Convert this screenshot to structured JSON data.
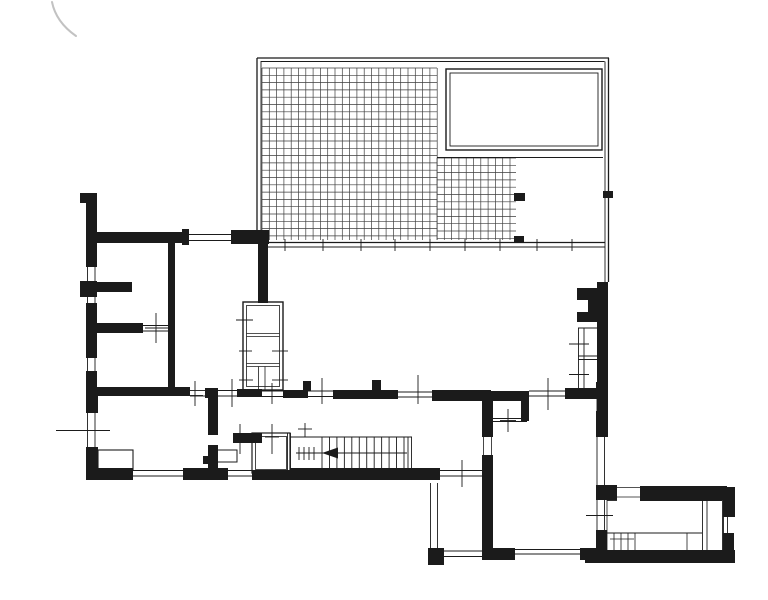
{
  "document": {
    "type": "scanned architectural floor plan drawing",
    "canvas": {
      "width": 768,
      "height": 600
    }
  },
  "colors": {
    "paper": "#ffffff",
    "ink": "#1b1b1b",
    "grid": "#3d3d3d",
    "pencil": "#c2c2c2"
  },
  "plan": {
    "pencil_mark_path": "M52,2 Q56,22 76,36",
    "grids": [
      {
        "x0": 262,
        "y0": 68,
        "x1": 437,
        "y1": 240,
        "step": 7.3
      },
      {
        "x0": 437,
        "y0": 158,
        "x1": 516,
        "y1": 240,
        "step": 7.3
      }
    ],
    "outline_rects": [
      [
        446,
        69,
        156,
        81,
        1.4
      ],
      [
        450,
        73,
        148,
        73,
        0.9
      ],
      [
        243,
        302,
        40,
        88,
        1.4
      ],
      [
        246.5,
        305.5,
        33,
        81,
        0.8
      ],
      [
        252,
        433,
        38,
        40,
        1.2
      ],
      [
        255.5,
        436.5,
        31,
        33,
        0.8
      ],
      [
        215,
        450,
        22,
        12,
        1
      ],
      [
        98,
        450,
        35,
        20,
        1.1
      ]
    ],
    "black_rects": [
      [
        80,
        193,
        17,
        10
      ],
      [
        86,
        203,
        11,
        30
      ],
      [
        86,
        232,
        102,
        11
      ],
      [
        182,
        229,
        7,
        16
      ],
      [
        231,
        230,
        38,
        14
      ],
      [
        86,
        243,
        11,
        24
      ],
      [
        86,
        281,
        11,
        16
      ],
      [
        80,
        281,
        6,
        16
      ],
      [
        86,
        303,
        11,
        55
      ],
      [
        86,
        371,
        11,
        27
      ],
      [
        97,
        282,
        35,
        10
      ],
      [
        95,
        323,
        48,
        10
      ],
      [
        168,
        243,
        7,
        147
      ],
      [
        97,
        387,
        93,
        9
      ],
      [
        205,
        388,
        13,
        10
      ],
      [
        208,
        398,
        10,
        37
      ],
      [
        208,
        445,
        10,
        23
      ],
      [
        237,
        389,
        25,
        8
      ],
      [
        283,
        390,
        25,
        8
      ],
      [
        303,
        381,
        8,
        10
      ],
      [
        333,
        390,
        65,
        9
      ],
      [
        372,
        380,
        9,
        14
      ],
      [
        432,
        390,
        59,
        11
      ],
      [
        482,
        391,
        47,
        10
      ],
      [
        521,
        392,
        8,
        29
      ],
      [
        482,
        392,
        11,
        45
      ],
      [
        482,
        455,
        11,
        102
      ],
      [
        565,
        388,
        42,
        11
      ],
      [
        596,
        382,
        11,
        15
      ],
      [
        596,
        411,
        11,
        26
      ],
      [
        596,
        485,
        11,
        15
      ],
      [
        596,
        530,
        11,
        21
      ],
      [
        258,
        243,
        10,
        60
      ],
      [
        233,
        433,
        29,
        10
      ],
      [
        86,
        388,
        12,
        25
      ],
      [
        86,
        447,
        12,
        33
      ],
      [
        86,
        468,
        47,
        12
      ],
      [
        183,
        468,
        45,
        12
      ],
      [
        252,
        470,
        38,
        10
      ],
      [
        290,
        468,
        150,
        12
      ],
      [
        203,
        456,
        9,
        8
      ],
      [
        428,
        548,
        16,
        17
      ],
      [
        482,
        548,
        33,
        12
      ],
      [
        580,
        548,
        27,
        12
      ],
      [
        585,
        550,
        150,
        13
      ],
      [
        600,
        485,
        17,
        15
      ],
      [
        640,
        486,
        87,
        14
      ],
      [
        723,
        487,
        12,
        30
      ],
      [
        723,
        533,
        11,
        30
      ],
      [
        597,
        282,
        11,
        155
      ],
      [
        514,
        193,
        11,
        8
      ],
      [
        514,
        236,
        10,
        7
      ],
      [
        603,
        191,
        10,
        7
      ]
    ],
    "polygons": [
      "577,288 597,288 597,322 577,322 577,312 588,312 588,300 577,300"
    ],
    "lines": [
      [
        257,
        232,
        257,
        58,
        1.3
      ],
      [
        261,
        232,
        261,
        61,
        0.9
      ],
      [
        257,
        58,
        609,
        58,
        1.3
      ],
      [
        261,
        61.5,
        604.5,
        61.5,
        0.9
      ],
      [
        608.5,
        58,
        608.5,
        282,
        1.3
      ],
      [
        605,
        61.5,
        605,
        282,
        0.9
      ],
      [
        437,
        157.5,
        603,
        157.5,
        0.9
      ],
      [
        268,
        242.5,
        605,
        242.5,
        1.2
      ],
      [
        268,
        247,
        605,
        247,
        0.9
      ],
      [
        285,
        239,
        285,
        251,
        0.9
      ],
      [
        323,
        239,
        323,
        251,
        0.9
      ],
      [
        361,
        239,
        361,
        251,
        0.9
      ],
      [
        395,
        239,
        395,
        251,
        0.9
      ],
      [
        430,
        239,
        430,
        251,
        0.9
      ],
      [
        465,
        239,
        465,
        251,
        0.9
      ],
      [
        500,
        239,
        500,
        251,
        0.9
      ],
      [
        537,
        239,
        537,
        251,
        0.9
      ],
      [
        572,
        239,
        572,
        251,
        0.9
      ],
      [
        189,
        234.5,
        231,
        234.5,
        0.9
      ],
      [
        189,
        240.5,
        231,
        240.5,
        0.9
      ],
      [
        87.5,
        267,
        87.5,
        281,
        0.9
      ],
      [
        95,
        267,
        95,
        281,
        0.9
      ],
      [
        87.5,
        297,
        87.5,
        303,
        0.9
      ],
      [
        95,
        297,
        95,
        303,
        0.9
      ],
      [
        87.5,
        358,
        87.5,
        371,
        0.9
      ],
      [
        95,
        358,
        95,
        371,
        0.9
      ],
      [
        87.5,
        413,
        87.5,
        447,
        0.9
      ],
      [
        95,
        413,
        95,
        447,
        0.9
      ],
      [
        56,
        430.5,
        110,
        430.5,
        0.9
      ],
      [
        143,
        325.5,
        168,
        325.5,
        0.9
      ],
      [
        143,
        331,
        168,
        331,
        0.9
      ],
      [
        156,
        313,
        156,
        343,
        0.9
      ],
      [
        145,
        328,
        168,
        328,
        0.9
      ],
      [
        133,
        470.5,
        183,
        470.5,
        0.9
      ],
      [
        133,
        476,
        183,
        476,
        0.9
      ],
      [
        228,
        470.5,
        252,
        470.5,
        0.9
      ],
      [
        228,
        476,
        252,
        476,
        0.9
      ],
      [
        190,
        390.5,
        205,
        390.5,
        0.9
      ],
      [
        190,
        396,
        205,
        396,
        0.9
      ],
      [
        195,
        381,
        195,
        406,
        0.9
      ],
      [
        188,
        395.5,
        203,
        395.5,
        0.9
      ],
      [
        218,
        390.5,
        237,
        390.5,
        0.9
      ],
      [
        218,
        396,
        237,
        396,
        0.9
      ],
      [
        232,
        379,
        232,
        407,
        0.9
      ],
      [
        262,
        391,
        283,
        391,
        0.9
      ],
      [
        262,
        396.5,
        283,
        396.5,
        0.9
      ],
      [
        272,
        383,
        272,
        404,
        0.9
      ],
      [
        308,
        391,
        333,
        391,
        0.9
      ],
      [
        308,
        396.5,
        333,
        396.5,
        0.9
      ],
      [
        322,
        378,
        322,
        404,
        0.9
      ],
      [
        398,
        392,
        432,
        392,
        0.9
      ],
      [
        398,
        397,
        432,
        397,
        0.9
      ],
      [
        418,
        375,
        418,
        404,
        0.9
      ],
      [
        529,
        391,
        565,
        391,
        0.9
      ],
      [
        529,
        396,
        565,
        396,
        0.9
      ],
      [
        548,
        378,
        548,
        410,
        0.9
      ],
      [
        246.5,
        333.5,
        279.5,
        333.5,
        0.8
      ],
      [
        246.5,
        336.5,
        279.5,
        336.5,
        0.8
      ],
      [
        246.5,
        363.5,
        279.5,
        363.5,
        0.8
      ],
      [
        246.5,
        366.5,
        279.5,
        366.5,
        0.8
      ],
      [
        258.5,
        366.5,
        258.5,
        389.5,
        0.8
      ],
      [
        265,
        366.5,
        265,
        389.5,
        0.8
      ],
      [
        236,
        320,
        253,
        320,
        0.9
      ],
      [
        239,
        351,
        252,
        351,
        0.9
      ],
      [
        272,
        351,
        288,
        351,
        0.9
      ],
      [
        239,
        380,
        253,
        380,
        0.9
      ],
      [
        272,
        380,
        288,
        380,
        0.9
      ],
      [
        287.5,
        433,
        287.5,
        470,
        0.9
      ],
      [
        290.5,
        433,
        290.5,
        470,
        0.9
      ],
      [
        290,
        437,
        412,
        437,
        0.9
      ],
      [
        408,
        437,
        408,
        468,
        0.9
      ],
      [
        411.5,
        437,
        411.5,
        468,
        0.9
      ],
      [
        305,
        423,
        305,
        437,
        0.9
      ],
      [
        298,
        429,
        312,
        429,
        0.9
      ],
      [
        240,
        424,
        240,
        454,
        0.9
      ],
      [
        233,
        437,
        247,
        437,
        0.9
      ],
      [
        272,
        424,
        272,
        454,
        0.9
      ],
      [
        265,
        437,
        279,
        437,
        0.9
      ],
      [
        488.5,
        397,
        488.5,
        421,
        0.9
      ],
      [
        488,
        418.5,
        527,
        418.5,
        0.9
      ],
      [
        488,
        421.5,
        527,
        421.5,
        0.9
      ],
      [
        508,
        409,
        508,
        432,
        0.9
      ],
      [
        500,
        420.5,
        516,
        420.5,
        0.9
      ],
      [
        483.5,
        437,
        483.5,
        455,
        0.8
      ],
      [
        491.5,
        437,
        491.5,
        455,
        0.8
      ],
      [
        440,
        470.5,
        482,
        470.5,
        0.9
      ],
      [
        440,
        476,
        482,
        476,
        0.9
      ],
      [
        462,
        460,
        462,
        487,
        0.9
      ],
      [
        430.5,
        483,
        430.5,
        548,
        0.9
      ],
      [
        437.5,
        483,
        437.5,
        548,
        0.9
      ],
      [
        444,
        551,
        482,
        551,
        0.9
      ],
      [
        444,
        556.5,
        482,
        556.5,
        0.9
      ],
      [
        515,
        549.5,
        580,
        549.5,
        0.9
      ],
      [
        515,
        554,
        580,
        554,
        0.9
      ],
      [
        597,
        397,
        597,
        411,
        0.9
      ],
      [
        604.5,
        397,
        604.5,
        411,
        0.9
      ],
      [
        597,
        437,
        597,
        485,
        0.9
      ],
      [
        604.5,
        437,
        604.5,
        485,
        0.9
      ],
      [
        597,
        500,
        597,
        530,
        0.9
      ],
      [
        604.5,
        500,
        604.5,
        530,
        0.9
      ],
      [
        586,
        515.5,
        613,
        515.5,
        0.9
      ],
      [
        578.5,
        328,
        578.5,
        390,
        0.9
      ],
      [
        584,
        328,
        584,
        390,
        0.9
      ],
      [
        578,
        328,
        597,
        328,
        0.9
      ],
      [
        578,
        356,
        597,
        356,
        0.9
      ],
      [
        578,
        359.5,
        597,
        359.5,
        0.9
      ],
      [
        569,
        344,
        589,
        344,
        0.9
      ],
      [
        569,
        374.5,
        589,
        374.5,
        0.9
      ],
      [
        617,
        487.5,
        640,
        487.5,
        0.8
      ],
      [
        617,
        497,
        640,
        497,
        0.8
      ],
      [
        723.5,
        517,
        723.5,
        533,
        0.9
      ],
      [
        727.5,
        517,
        727.5,
        533,
        0.9
      ],
      [
        607,
        500.5,
        617,
        500.5,
        0.9
      ],
      [
        640,
        500.5,
        722,
        500.5,
        0.9
      ],
      [
        607,
        500,
        607,
        550,
        0.8
      ],
      [
        607,
        533,
        702,
        533,
        0.9
      ],
      [
        702.5,
        500,
        702.5,
        550,
        0.9
      ],
      [
        707,
        500,
        707,
        550,
        0.9
      ],
      [
        722.5,
        500,
        722.5,
        550,
        0.9
      ],
      [
        614,
        533,
        614,
        550,
        0.8
      ],
      [
        621,
        533,
        621,
        550,
        0.8
      ],
      [
        628,
        533,
        628,
        550,
        0.8
      ],
      [
        635,
        533,
        635,
        550,
        0.8
      ],
      [
        687,
        533,
        687,
        550,
        0.8
      ],
      [
        610,
        539,
        634,
        539,
        0.8
      ]
    ],
    "stairs": {
      "x0": 322,
      "y0": 437,
      "x1": 404,
      "y1": 468,
      "count": 12
    },
    "stair_arrow": {
      "y": 453,
      "x0": 296,
      "x1": 407,
      "tip": 322,
      "back": 338,
      "half": 5.5,
      "ticks": [
        299,
        304,
        309,
        314
      ],
      "tick_y0": 447,
      "tick_y1": 460
    }
  }
}
